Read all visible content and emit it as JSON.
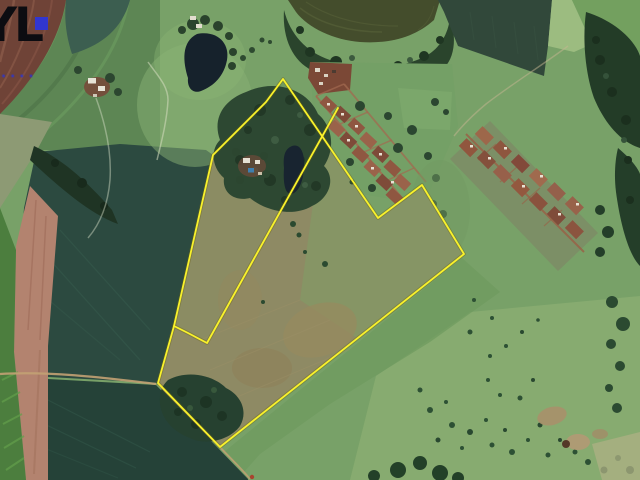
{
  "watermark": {
    "letters": "YL",
    "tagline": "••••",
    "letter_color": "#0c0c11",
    "square_color": "#3136d0",
    "tagline_color": "#2f36c8"
  },
  "map": {
    "type": "satellite-imagery",
    "scene": "rural property with crop fields, pond, village and pasture",
    "boundary": {
      "color": "#f9f22b",
      "outer_points": "283,79 378,218 422,185 464,254 220,447 158,383 174,326 213,155 266,102",
      "divider_points": "174,326 188,333 207,343 338,108"
    }
  }
}
